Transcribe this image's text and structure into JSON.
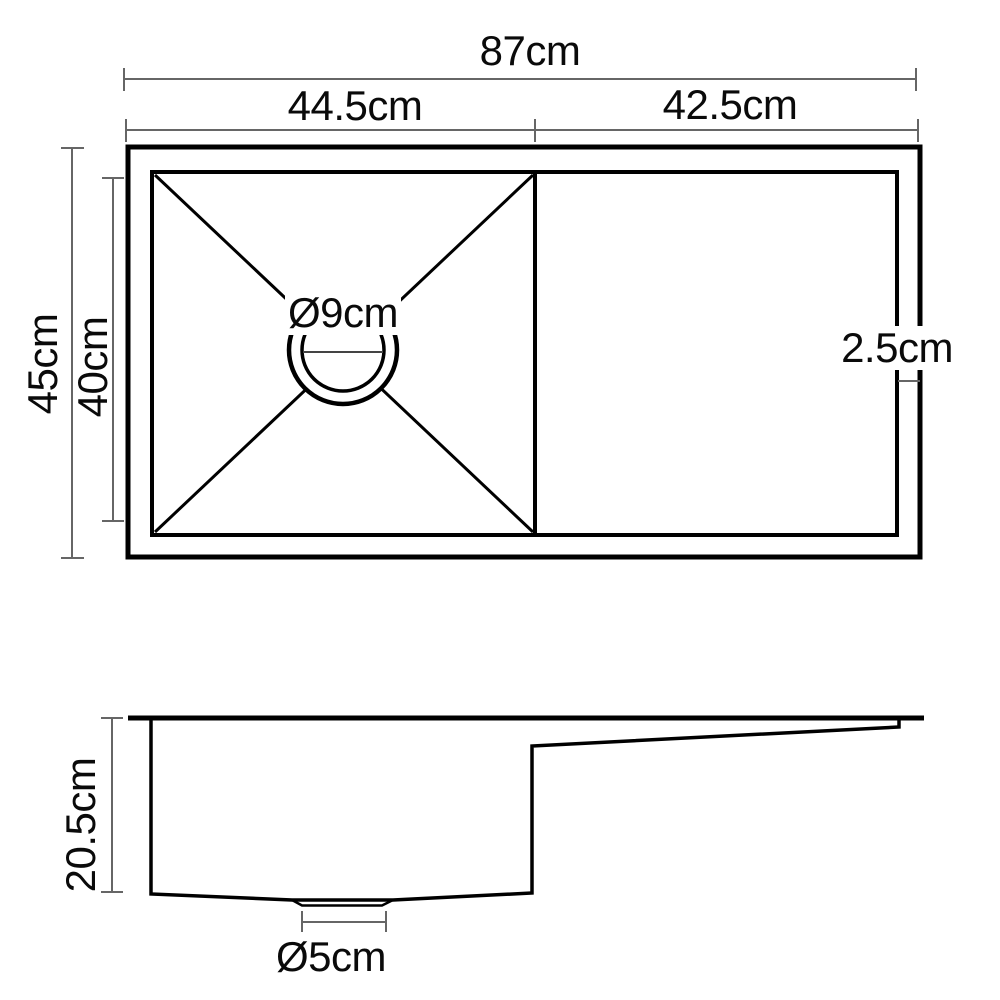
{
  "diagram": {
    "kind": "sink-dimension-drawing",
    "colors": {
      "outline": "#000000",
      "dimension_line": "#666666",
      "text": "#0a0a0a",
      "background": "#ffffff"
    },
    "top_view": {
      "labels": {
        "overall_width": "87cm",
        "bowl_width": "44.5cm",
        "drainer_width": "42.5cm",
        "overall_depth": "45cm",
        "bowl_depth": "40cm",
        "rim_width": "2.5cm",
        "drain_diameter": "Ø9cm"
      }
    },
    "side_view": {
      "labels": {
        "bowl_depth": "20.5cm",
        "drain_diameter": "Ø5cm"
      }
    }
  }
}
